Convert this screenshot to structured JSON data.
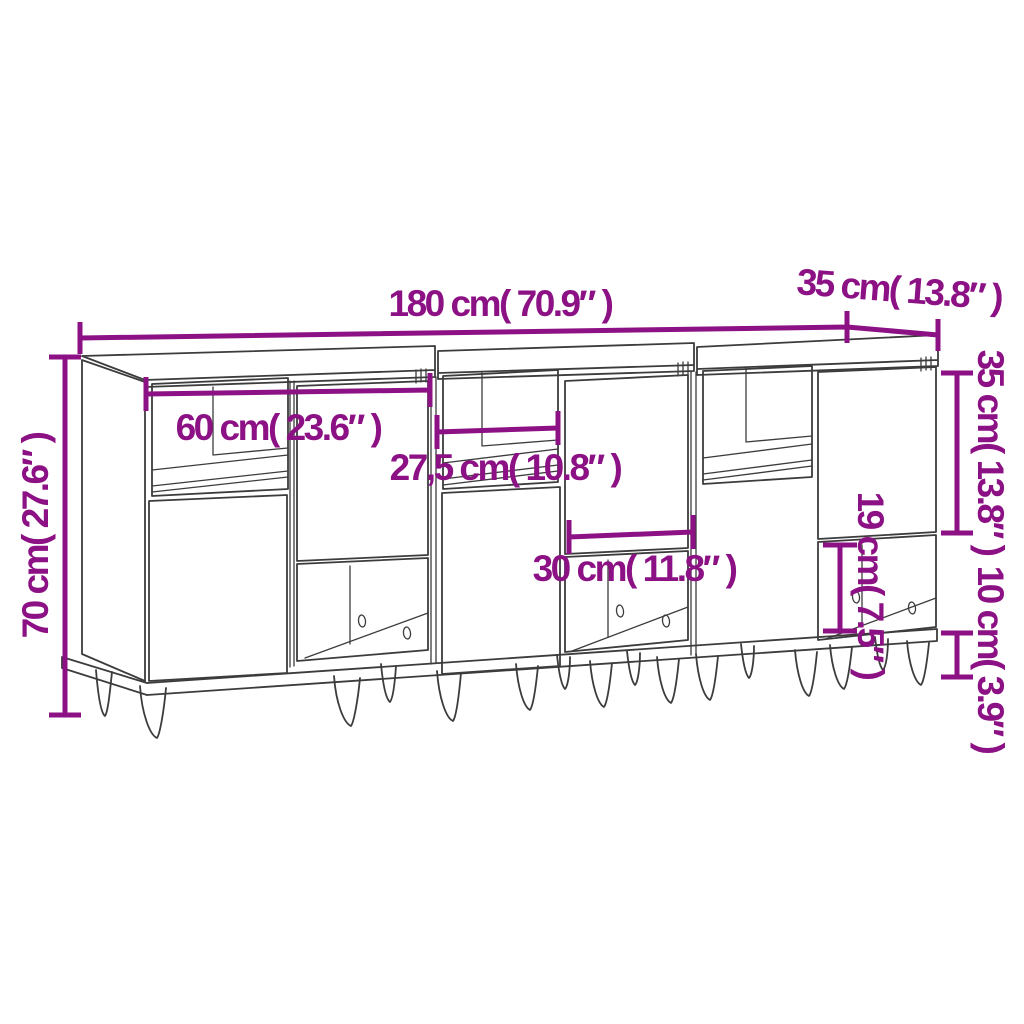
{
  "diagram": {
    "subject": "Three sideboards with hairpin legs - dimension drawing",
    "colors": {
      "dimension_accent": "#8c1184",
      "linework": "#3c3c3c",
      "background": "#ffffff"
    },
    "dimensions": {
      "total_width": "180 cm( 70.9″ )",
      "top_depth": "35 cm( 13.8″ )",
      "total_height": "70 cm( 27.6″ )",
      "unit_width": "60 cm( 23.6″ )",
      "open_shelf_width": "27,5 cm( 10.8″ )",
      "door_width": "30 cm( 11.8″ )",
      "door_height": "35 cm( 13.8″ )",
      "open_compartment_height": "19 cm( 7.5″ )",
      "leg_height": "10 cm( 3.9″ )"
    }
  }
}
